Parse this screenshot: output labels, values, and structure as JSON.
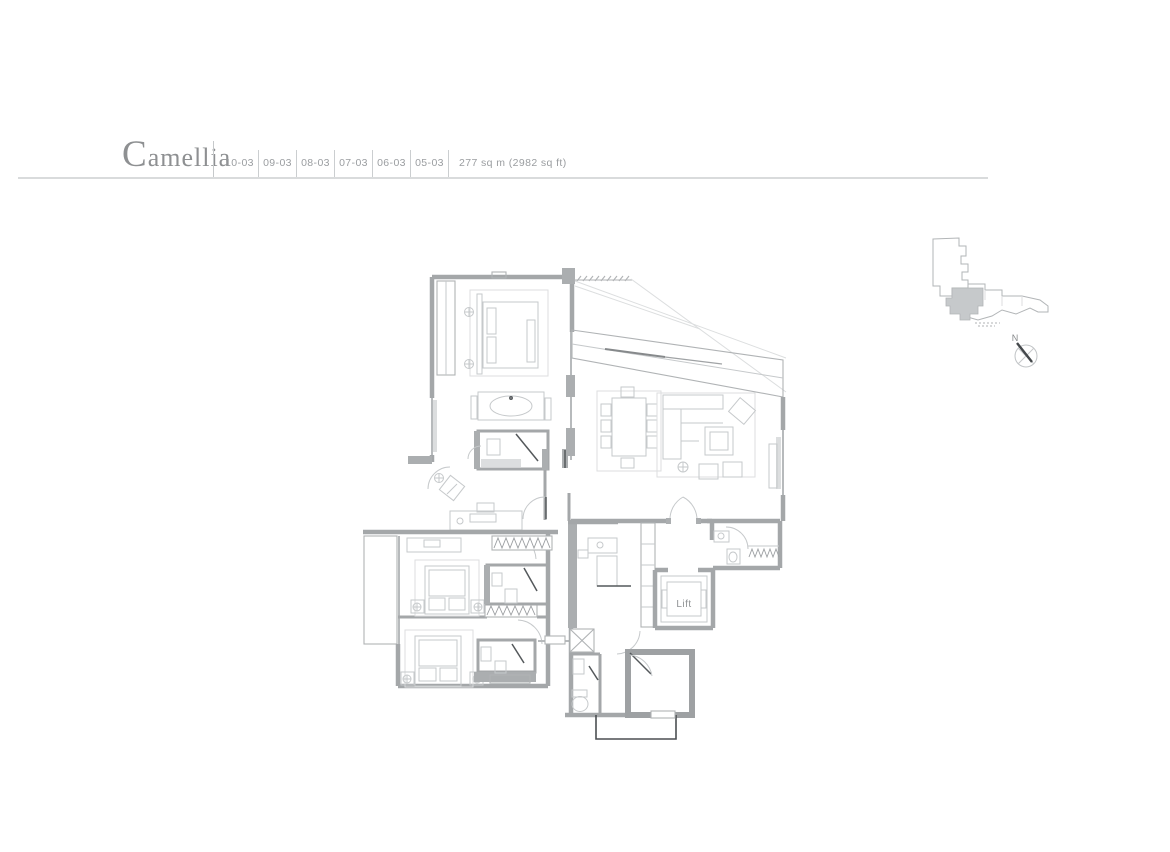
{
  "header": {
    "title": "Camellia",
    "units": [
      "10-03",
      "09-03",
      "08-03",
      "07-03",
      "06-03",
      "05-03"
    ],
    "area": "277 sq m (2982 sq ft)"
  },
  "floor_plan": {
    "lift_label": "Lift"
  },
  "key_plan": {
    "compass_label": "N"
  },
  "colors": {
    "wall_gray": "#a4a7a9",
    "furniture_gray": "#c6c9cb",
    "dark_accent": "#54585b",
    "text_gray": "#9a9da0",
    "title_gray": "#8e9092",
    "unit_highlight": "#c6c9cb"
  }
}
